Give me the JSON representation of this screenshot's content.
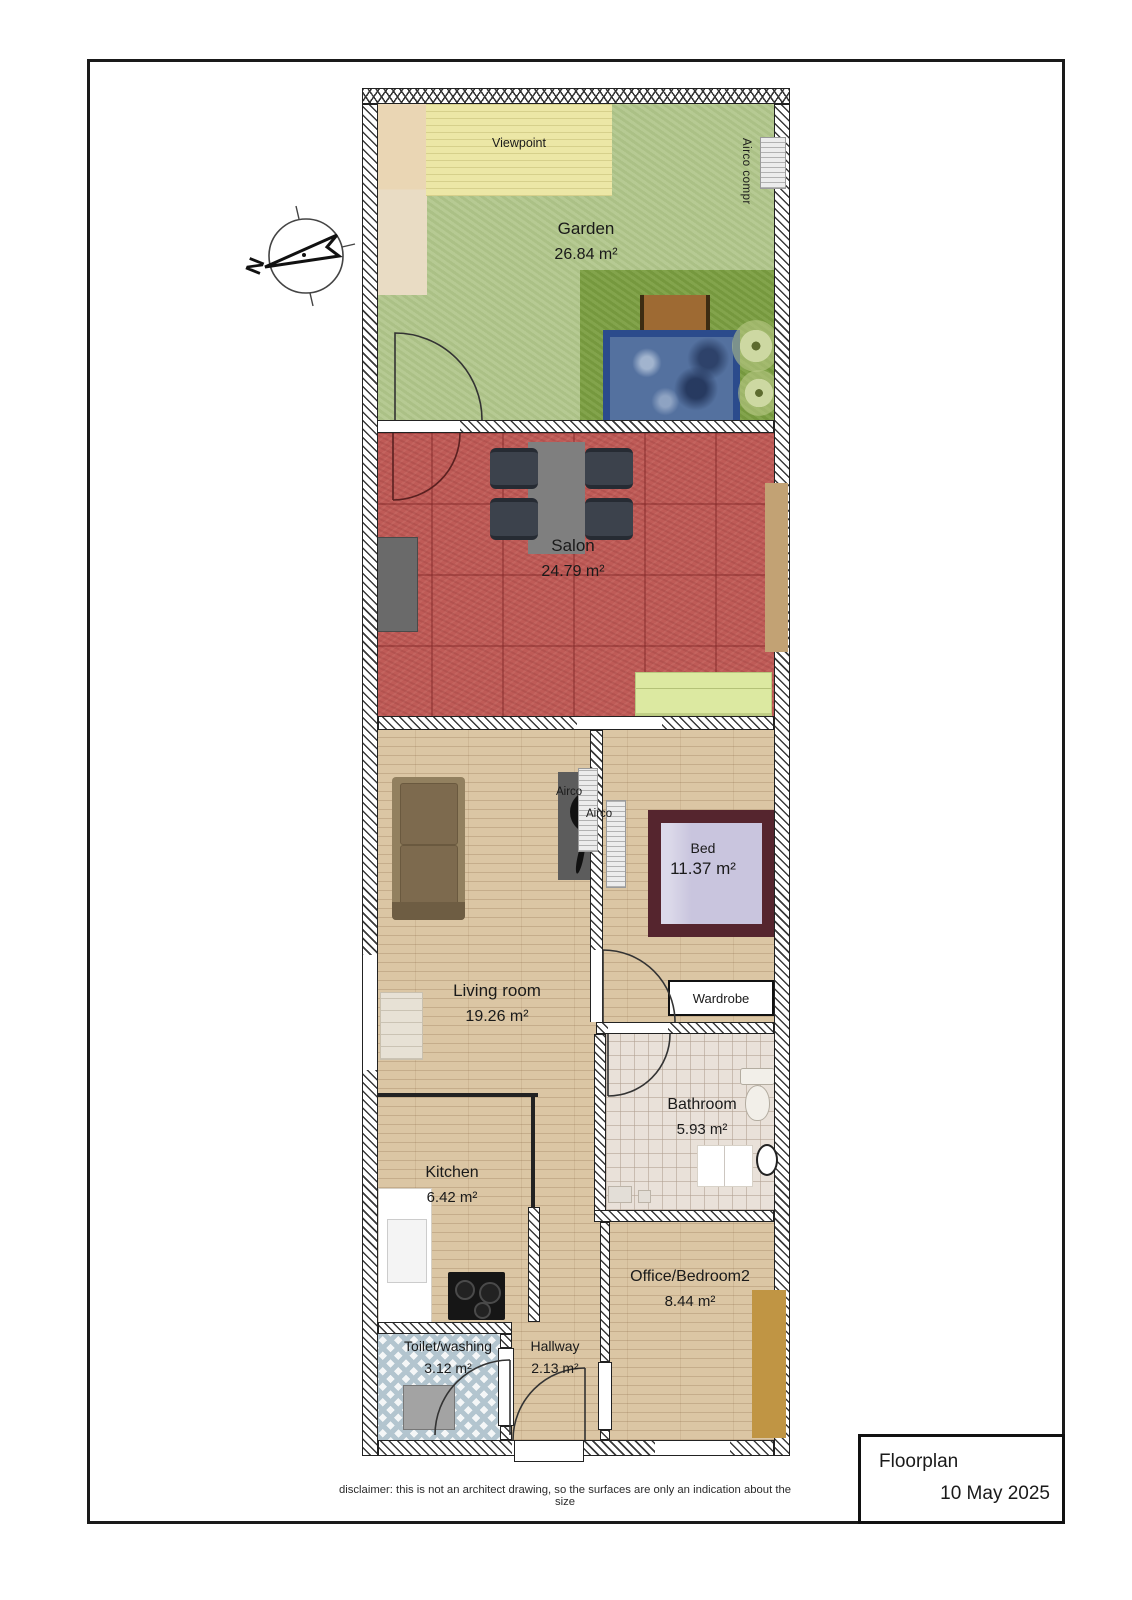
{
  "title_block": {
    "title": "Floorplan",
    "date": "10 May 2025"
  },
  "disclaimer": "disclaimer: this is not an architect drawing, so the surfaces are only an indication about the size",
  "compass": {
    "north_letter": "N"
  },
  "rooms": [
    {
      "id": "garden",
      "name": "Garden",
      "area": "26.84 m²"
    },
    {
      "id": "salon",
      "name": "Salon",
      "area": "24.79 m²"
    },
    {
      "id": "living",
      "name": "Living room",
      "area": "19.26 m²"
    },
    {
      "id": "bed",
      "name": "Bed",
      "area": "11.37 m²"
    },
    {
      "id": "bathroom",
      "name": "Bathroom",
      "area": "5.93 m²"
    },
    {
      "id": "kitchen",
      "name": "Kitchen",
      "area": "6.42 m²"
    },
    {
      "id": "toilet",
      "name": "Toilet/washing",
      "area": "3.12 m²"
    },
    {
      "id": "hallway",
      "name": "Hallway",
      "area": "2.13 m²"
    },
    {
      "id": "office",
      "name": "Office/Bedroom2",
      "area": "8.44 m²"
    }
  ],
  "labels": {
    "viewpoint": "Viewpoint",
    "airco_compr": "Airco compr",
    "airco_1": "Airco",
    "airco_2": "Airco",
    "wardrobe": "Wardrobe"
  },
  "colors": {
    "garden_green": "#b2c78c",
    "garden_dark_green": "#7c9f42",
    "viewpoint_yellow": "#ece7a6",
    "terrace_beige": "#ead6b4",
    "pool_frame": "#2b4b8c",
    "pool_water": "#54719f",
    "table_brown": "#9e6a33",
    "salon_red": "#bf5b57",
    "chair_dark": "#3c424c",
    "table_gray": "#7f7f7f",
    "cabinet_gray": "#6a6a6a",
    "sofa_green": "#dce9a1",
    "door_tan": "#c2a274",
    "wood_floor": "#dbc6a4",
    "sofa_brown": "#92805f",
    "bed_frame": "#55252e",
    "mattress": "#c9c5de",
    "bath_tile": "#e9e1d9",
    "toilet_tile": "#b3c5cf",
    "desk_tan": "#c09544",
    "stove_black": "#161616",
    "washer_gray": "#a3a3a3"
  }
}
